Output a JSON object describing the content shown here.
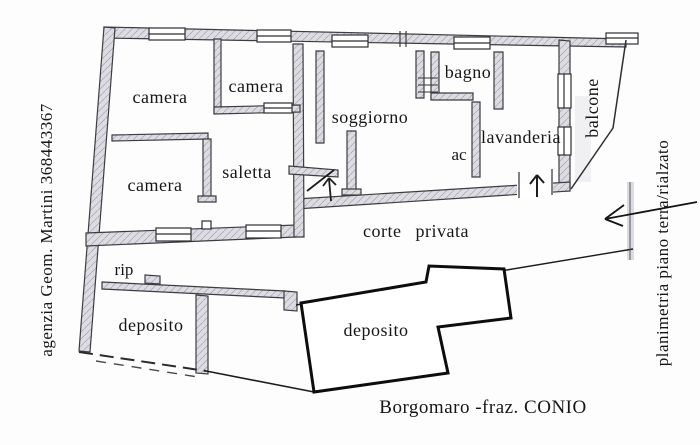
{
  "plan": {
    "rooms": [
      {
        "id": "camera-1",
        "label": "camera"
      },
      {
        "id": "camera-2",
        "label": "camera"
      },
      {
        "id": "bagno",
        "label": "bagno"
      },
      {
        "id": "soggiorno",
        "label": "soggiorno"
      },
      {
        "id": "lavanderia",
        "label": "lavanderia"
      },
      {
        "id": "ac",
        "label": "ac"
      },
      {
        "id": "balcone",
        "label": "balcone"
      },
      {
        "id": "saletta",
        "label": "saletta"
      },
      {
        "id": "camera-3",
        "label": "camera"
      },
      {
        "id": "corte-privata",
        "label": "corte privata"
      },
      {
        "id": "rip",
        "label": "rip"
      },
      {
        "id": "deposito-1",
        "label": "deposito"
      },
      {
        "id": "deposito-2",
        "label": "deposito"
      }
    ],
    "annotations": {
      "left_vertical": "agenzia Geom. Martini 368443367",
      "right_vertical": "planimetria piano terra/rialzato",
      "bottom_caption": "Borgomaro -fraz. CONIO"
    },
    "colors": {
      "background": "#fdfdfd",
      "wall_fill": "#dcdce2",
      "line": "#2e2e33",
      "bold_outline": "#0d0d0d",
      "text": "#161616"
    }
  }
}
